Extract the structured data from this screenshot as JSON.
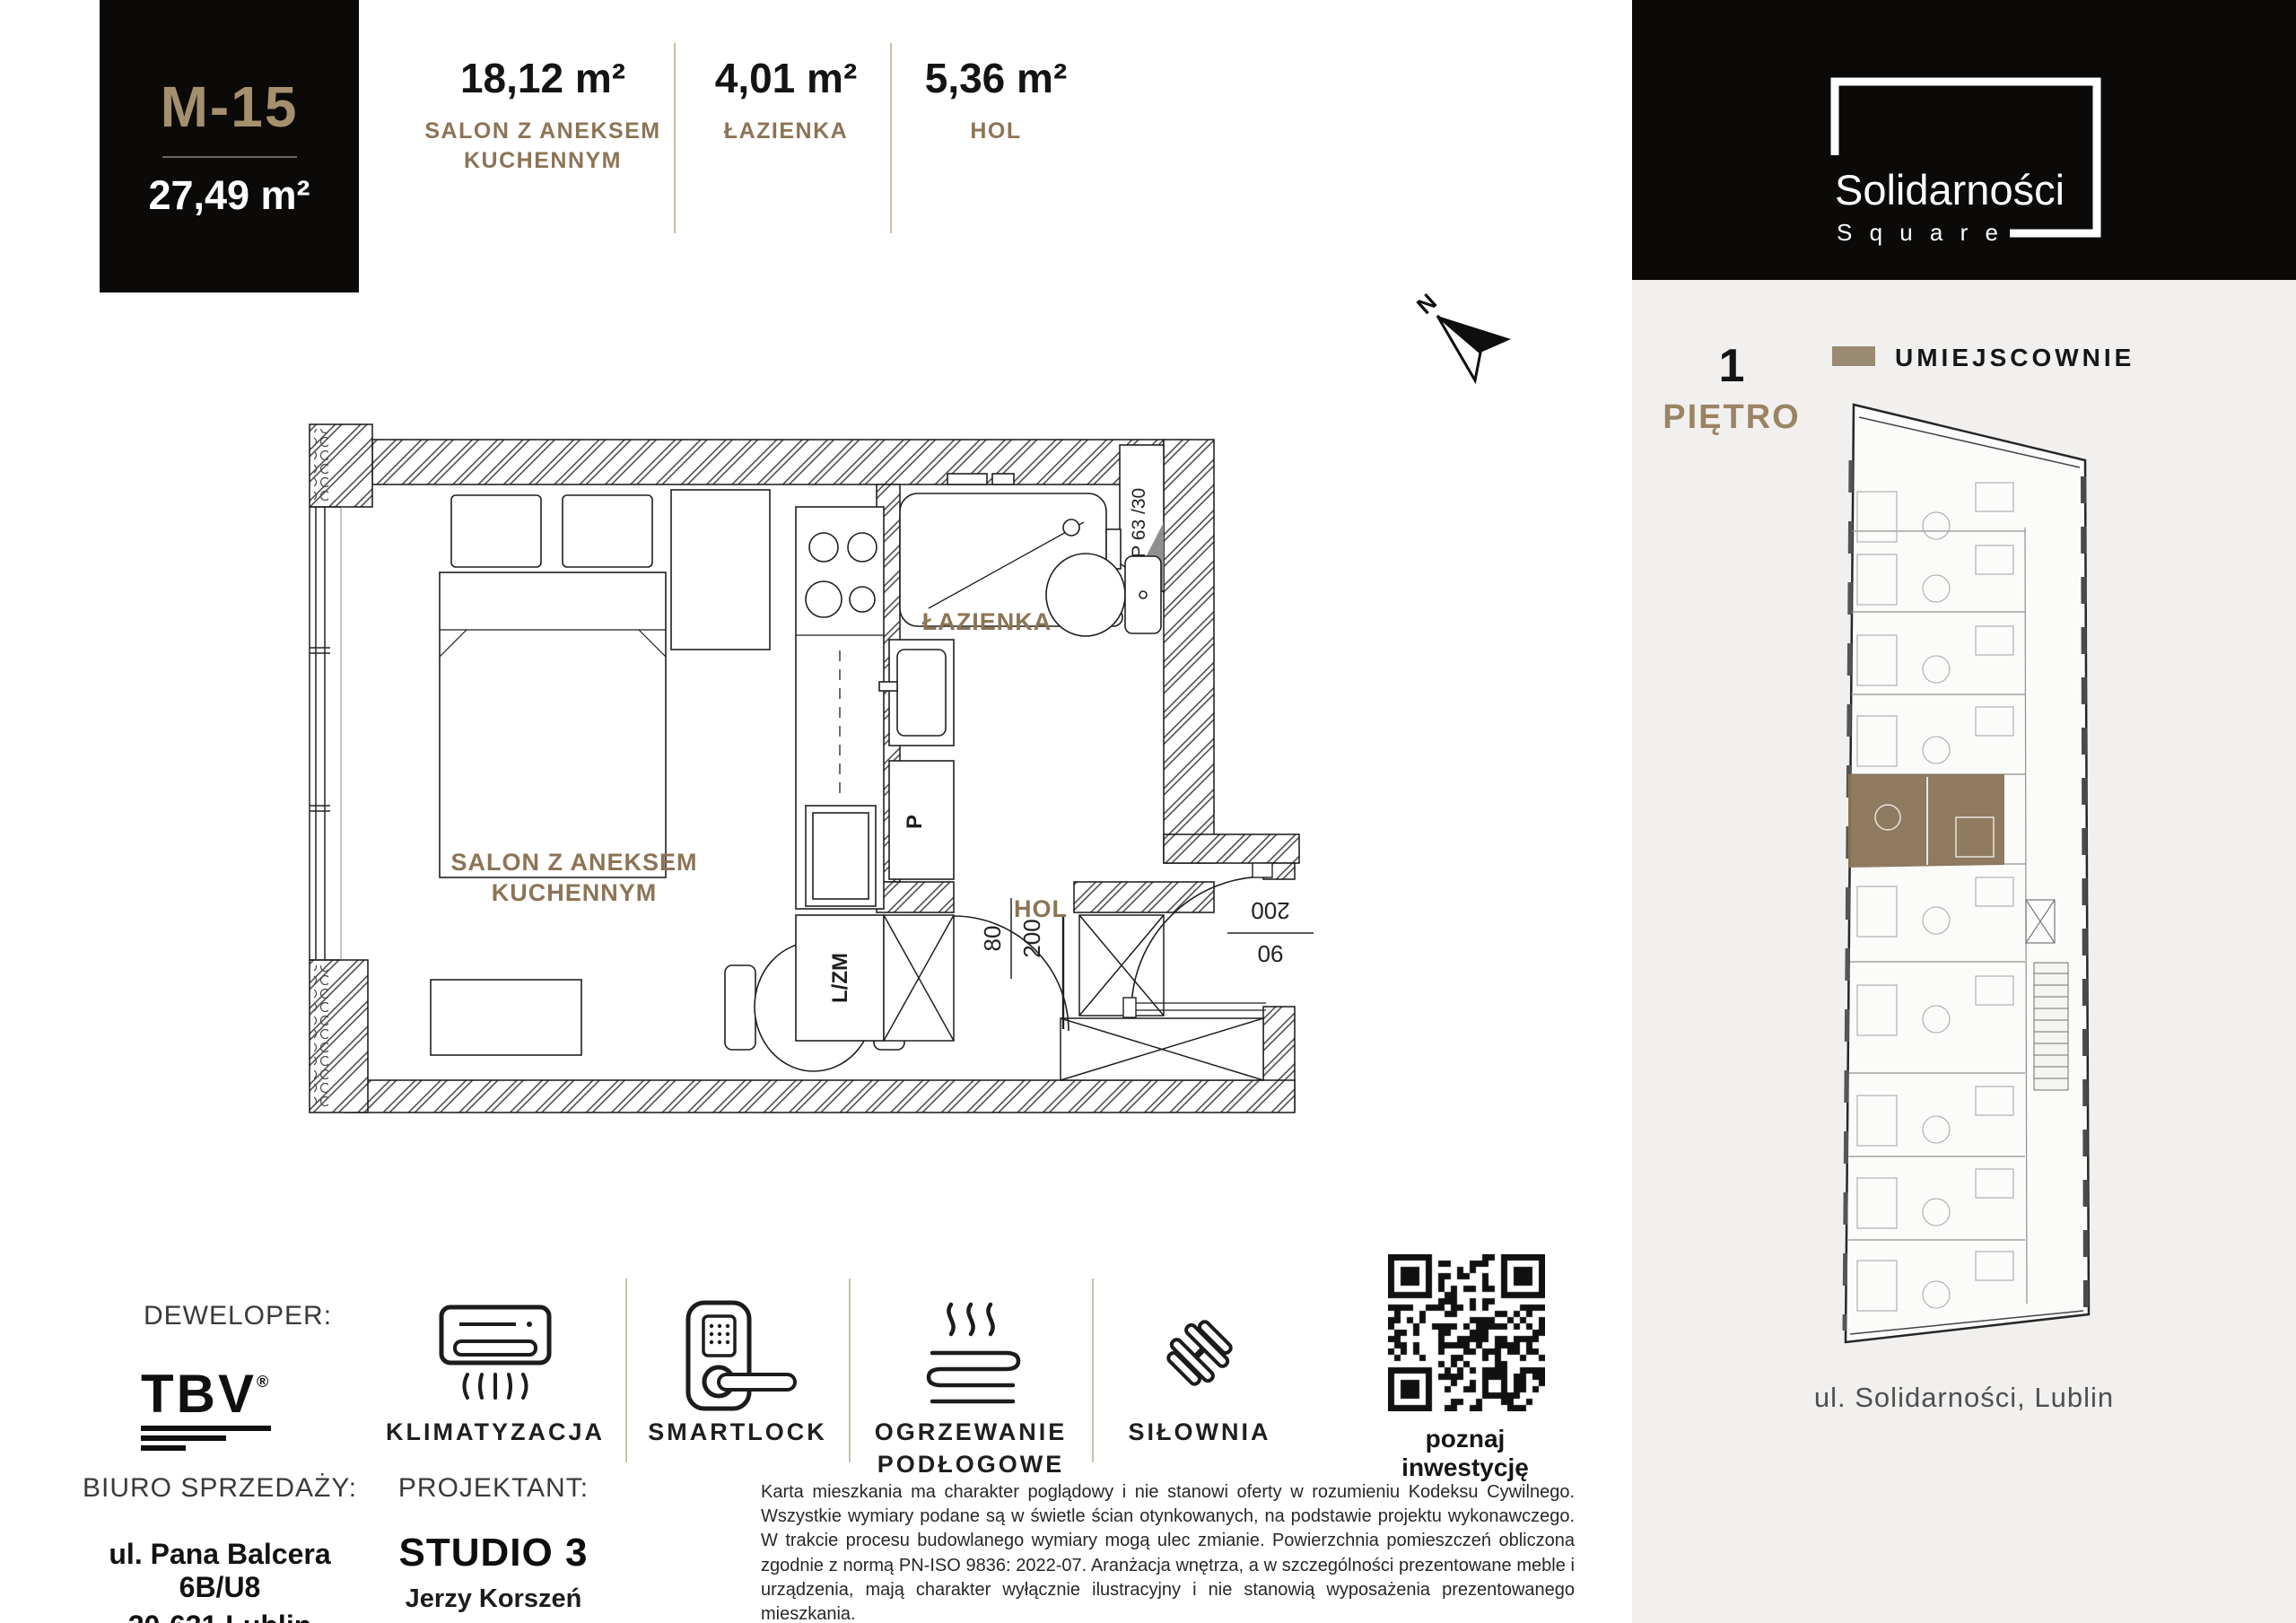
{
  "unit_card": {
    "code": "M-15",
    "area": "27,49 m²"
  },
  "stats": [
    {
      "value": "18,12 m²",
      "label_line1": "SALON Z ANEKSEM",
      "label_line2": "KUCHENNYM"
    },
    {
      "value": "4,01 m²",
      "label_line1": "ŁAZIENKA",
      "label_line2": ""
    },
    {
      "value": "5,36 m²",
      "label_line1": "HOL",
      "label_line2": ""
    }
  ],
  "plan": {
    "salon_line1": "SALON Z ANEKSEM",
    "salon_line2": "KUCHENNYM",
    "lazienka": "ŁAZIENKA",
    "hol": "HOL",
    "washer": "L/ZM",
    "p": "P",
    "window_code": "OP 63 /30",
    "bath_door": {
      "width": "80",
      "height": "200"
    },
    "entry_door": {
      "height": "200",
      "width": "90"
    },
    "north": "N"
  },
  "brand": {
    "name": "Solidarności",
    "sub": "S q u a r e"
  },
  "floor": {
    "number": "1",
    "label": "PIĘTRO",
    "legend_label": "UMIEJSCOWNIE"
  },
  "location_label": "ul. Solidarności, Lublin",
  "developer": {
    "label": "DEWELOPER:",
    "brand": "TBV",
    "reg": "®"
  },
  "features": [
    {
      "icon": "air-conditioner-icon",
      "label": "KLIMATYZACJA"
    },
    {
      "icon": "smartlock-icon",
      "label": "SMARTLOCK"
    },
    {
      "icon": "floor-heating-icon",
      "label": "OGRZEWANIE PODŁOGOWE"
    },
    {
      "icon": "dumbbell-icon",
      "label": "SIŁOWNIA"
    }
  ],
  "qr": {
    "caption": "poznaj inwestycję"
  },
  "sales_office": {
    "label": "BIURO SPRZEDAŻY:",
    "address_line1": "ul. Pana Balcera 6B/U8",
    "address_line2": "20-631 Lublin"
  },
  "designer": {
    "label": "PROJEKTANT:",
    "studio": "STUDIO 3",
    "name": "Jerzy Korszeń"
  },
  "disclaimer": "Karta mieszkania ma charakter poglądowy i nie stanowi oferty w rozumieniu Kodeksu Cywilnego. Wszystkie wymiary podane są w świetle ścian otynkowanych, na podstawie projektu wykonawczego. W trakcie procesu budowlanego wymiary mogą ulec zmianie. Powierzchnia pomieszczeń obliczona zgodnie z normą PN-ISO 9836: 2022-07. Aranżacja wnętrza, a w szczególności prezentowane meble i urządzenia, mają charakter wyłącznie ilustracyjny i nie stanowią wyposażenia prezentowanego mieszkania.",
  "colors": {
    "accent_brown": "#8C7456",
    "gold_tan": "#A5906E",
    "swatch": "#9B8A72",
    "panel_bg": "#F1F0EE",
    "black": "#0B0A09"
  }
}
